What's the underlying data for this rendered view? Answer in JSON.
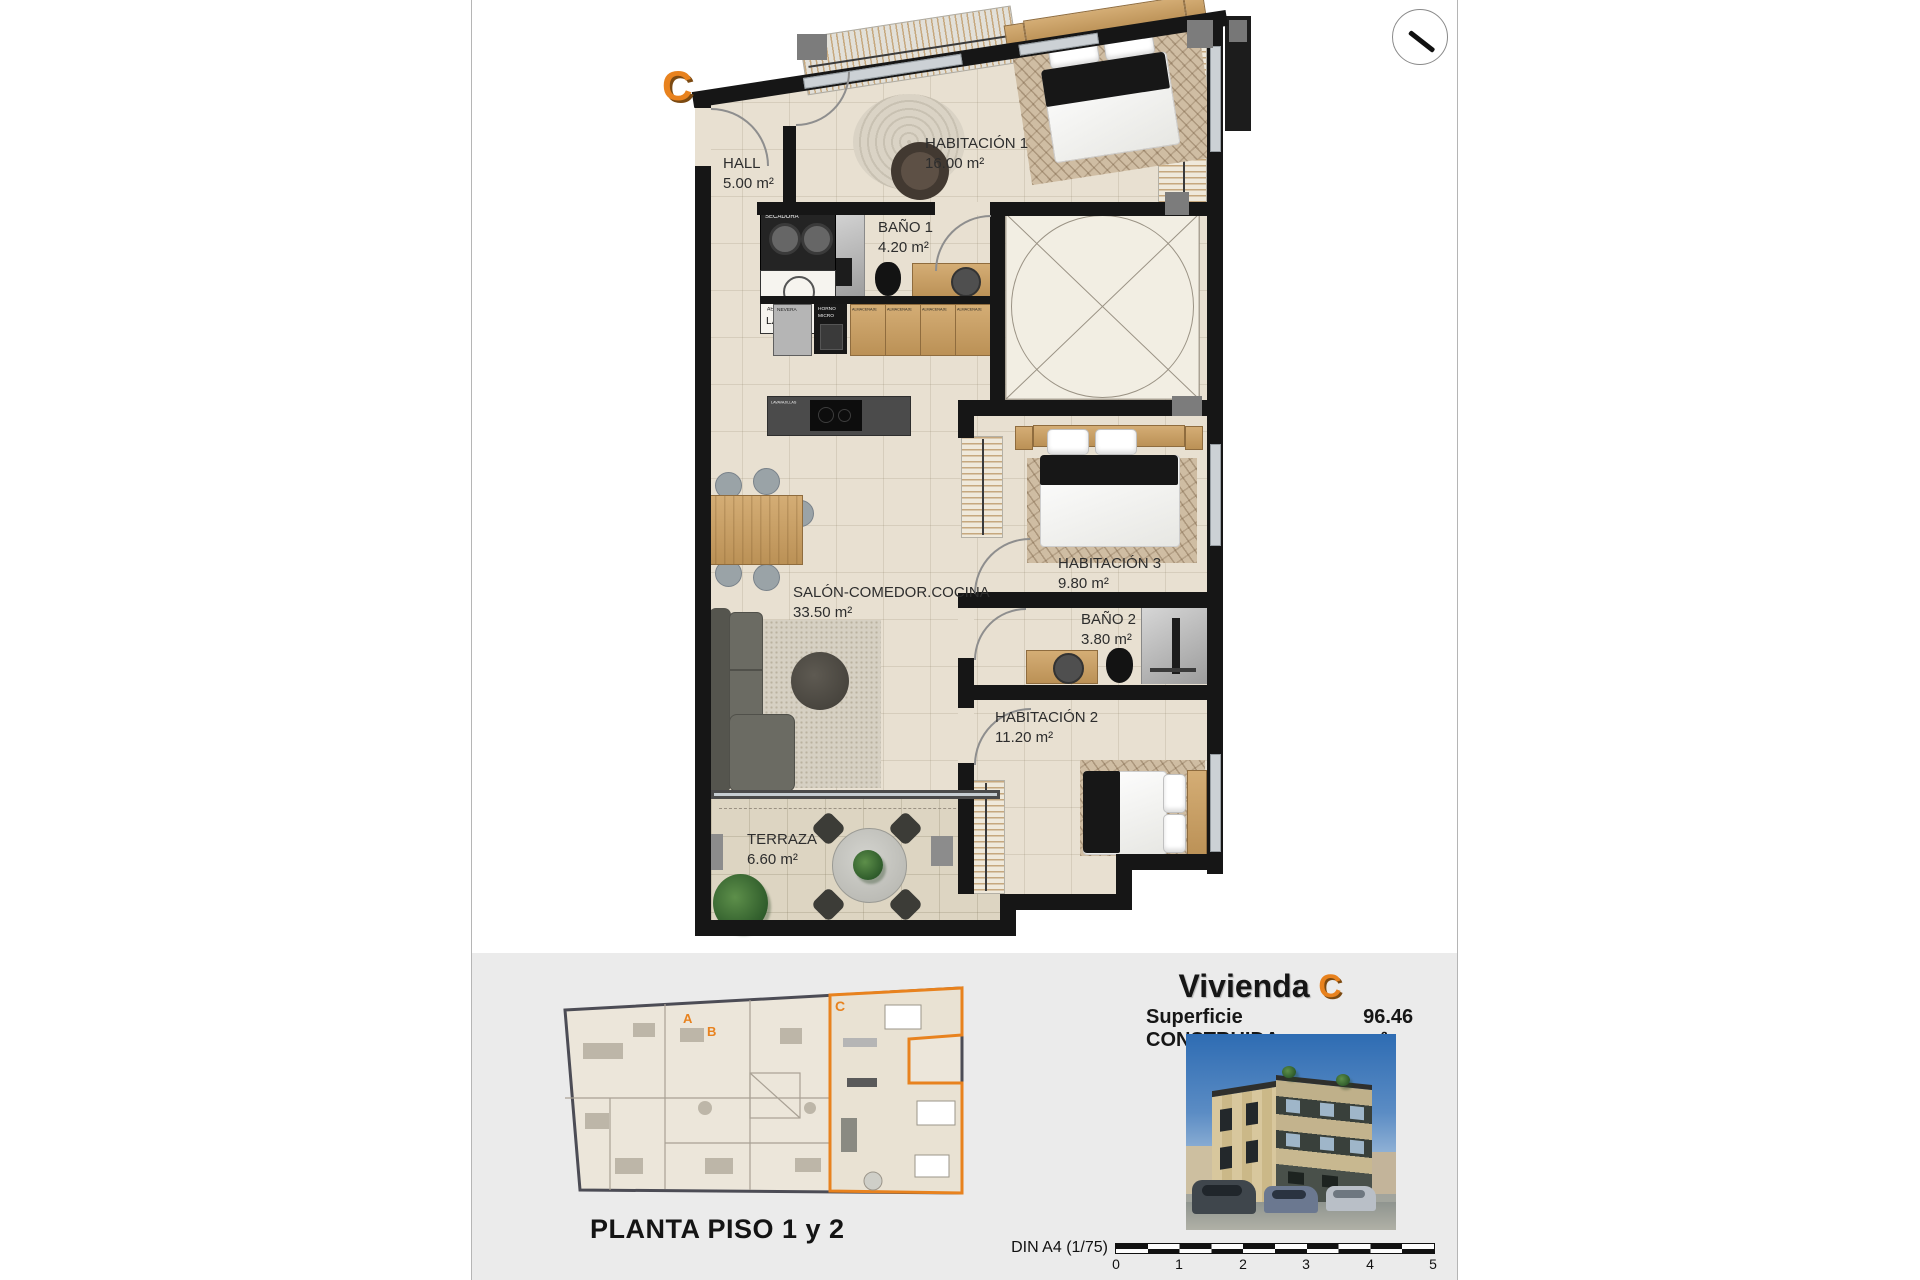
{
  "colors": {
    "accent_orange": "#e8821e",
    "wall": "#161616",
    "floor_beige": "#e8e0d1",
    "panel_gray": "#ebebeb",
    "wood": "#c9a76b"
  },
  "plan": {
    "unit_letter": "C",
    "rooms": [
      {
        "name": "HALL",
        "area": "5.00 m²"
      },
      {
        "name": "HABITACIÓN 1",
        "area": "16.00 m²"
      },
      {
        "name": "BAÑO 1",
        "area": "4.20 m²"
      },
      {
        "name": "SALÓN-COMEDOR.COCINA",
        "area": "33.50 m²"
      },
      {
        "name": "HABITACIÓN 3",
        "area": "9.80 m²"
      },
      {
        "name": "BAÑO 2",
        "area": "3.80 m²"
      },
      {
        "name": "HABITACIÓN 2",
        "area": "11.20 m²"
      },
      {
        "name": "TERRAZA",
        "area": "6.60 m²"
      }
    ],
    "fixtures": {
      "lavadora": "LAVADORA",
      "secadora": "SECADORA",
      "aerotermia": "AEROTERMIA",
      "lavado": "LAVADO",
      "nevera": "NEVERA",
      "horno": "HORNO",
      "micro": "MICRO",
      "almacenaje": "ALMACENAJE",
      "lavavajillas": "LAVAVAJILLAS"
    }
  },
  "footer": {
    "overview": {
      "caption": "PLANTA PISO 1 y 2",
      "unit_labels": {
        "a": "A",
        "b": "B",
        "c": "C"
      }
    },
    "title": {
      "prefix": "Vivienda",
      "letter": "C"
    },
    "surface": {
      "label": "Superficie CONSTRUIDA",
      "value": "96.46 m²"
    },
    "scale_bar": {
      "label": "DIN A4 (1/75)",
      "ticks": [
        "0",
        "1",
        "2",
        "3",
        "4",
        "5"
      ]
    }
  }
}
